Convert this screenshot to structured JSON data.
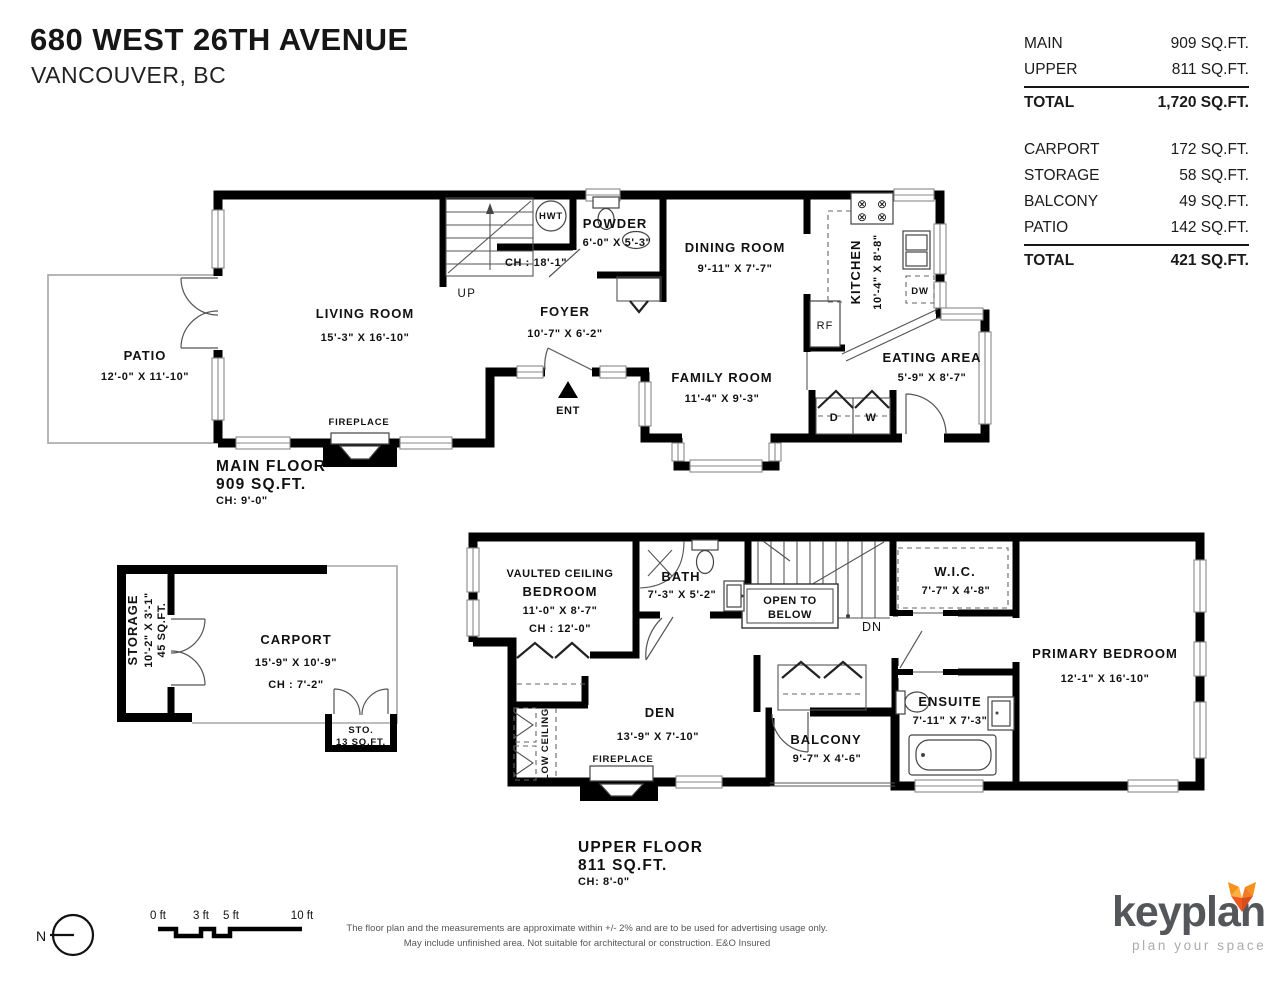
{
  "header": {
    "address": "680 WEST 26TH AVENUE",
    "city": "VANCOUVER, BC"
  },
  "area_table": {
    "floor_rows": [
      {
        "label": "MAIN",
        "value": "909 SQ.FT."
      },
      {
        "label": "UPPER",
        "value": "811 SQ.FT."
      }
    ],
    "floor_total": {
      "label": "TOTAL",
      "value": "1,720 SQ.FT."
    },
    "other_rows": [
      {
        "label": "CARPORT",
        "value": "172 SQ.FT."
      },
      {
        "label": "STORAGE",
        "value": "58 SQ.FT."
      },
      {
        "label": "BALCONY",
        "value": "49 SQ.FT."
      },
      {
        "label": "PATIO",
        "value": "142 SQ.FT."
      }
    ],
    "other_total": {
      "label": "TOTAL",
      "value": "421 SQ.FT."
    }
  },
  "main_floor": {
    "title": "MAIN FLOOR",
    "area": "909 SQ.FT.",
    "ceiling": "CH: 9'-0\"",
    "rooms": {
      "patio": {
        "name": "PATIO",
        "dims": "12'-0\"  X  11'-10\""
      },
      "living": {
        "name": "LIVING ROOM",
        "dims": "15'-3\"  X  16'-10\""
      },
      "foyer": {
        "name": "FOYER",
        "dims": "10'-7\"  X  6'-2\""
      },
      "powder": {
        "name": "POWDER",
        "dims": "6'-0\" X 5'-3\""
      },
      "dining": {
        "name": "DINING ROOM",
        "dims": "9'-11\"  X  7'-7\""
      },
      "kitchen": {
        "name": "KITCHEN",
        "dims": "10'-4\" X 8'-8\""
      },
      "eating": {
        "name": "EATING AREA",
        "dims": "5'-9\"  X  8'-7\""
      },
      "family": {
        "name": "FAMILY ROOM",
        "dims": "11'-4\"  X  9'-3\""
      }
    },
    "labels": {
      "up": "UP",
      "stair_ch": "CH : 18'-1\"",
      "hwt": "HWT",
      "ent": "ENT",
      "fireplace": "FIREPLACE",
      "rf": "RF",
      "dw": "DW",
      "dryer": "D",
      "washer": "W"
    }
  },
  "upper_floor": {
    "title": "UPPER FLOOR",
    "area": "811 SQ.FT.",
    "ceiling": "CH: 8'-0\"",
    "rooms": {
      "bedroom": {
        "name_line1": "VAULTED CEILING",
        "name_line2": "BEDROOM",
        "dims": "11'-0\"  X  8'-7\"",
        "ceiling": "CH : 12'-0\""
      },
      "bath": {
        "name": "BATH",
        "dims": "7'-3\" X 5'-2\""
      },
      "wic": {
        "name": "W.I.C.",
        "dims": "7'-7\"  X  4'-8\""
      },
      "primary": {
        "name": "PRIMARY BEDROOM",
        "dims": "12'-1\"  X  16'-10\""
      },
      "ensuite": {
        "name": "ENSUITE",
        "dims": "7'-11\" X 7'-3\""
      },
      "den": {
        "name": "DEN",
        "dims": "13'-9\"  X  7'-10\""
      },
      "balcony": {
        "name": "BALCONY",
        "dims": "9'-7\"  X  4'-6\""
      }
    },
    "labels": {
      "open_below_1": "OPEN TO",
      "open_below_2": "BELOW",
      "dn": "DN",
      "fireplace": "FIREPLACE",
      "low_ceiling": "LOW CEILING"
    }
  },
  "carport": {
    "name": "CARPORT",
    "dims": "15'-9\"  X  10'-9\"",
    "ceiling": "CH : 7'-2\"",
    "storage": {
      "name": "STORAGE",
      "dims": "10'-2\" X 3'-1\"",
      "area": "45 SQ.FT."
    },
    "sto": {
      "name": "STO.",
      "area": "13 SQ.FT."
    }
  },
  "footer": {
    "north": "N",
    "scale_labels": [
      "0 ft",
      "3 ft",
      "5 ft",
      "10 ft"
    ],
    "disclaimer_line1": "The floor plan and the measurements are approximate within +/- 2% and are to be used for advertising usage only.",
    "disclaimer_line2": "May include unfinished area. Not suitable for architectural or construction. E&O Insured",
    "brand": "keyplan",
    "tagline": "plan your space"
  }
}
